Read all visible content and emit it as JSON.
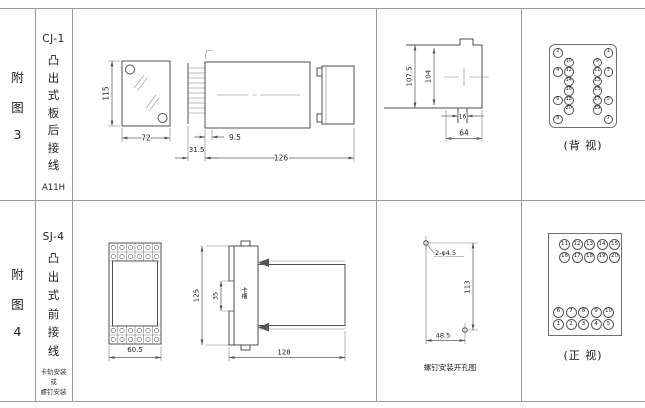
{
  "figures": {
    "fig3": {
      "index_chars": [
        "附",
        "图",
        "3"
      ],
      "model": "CJ-1",
      "type_chars": [
        "凸",
        "出",
        "式",
        "板",
        "后",
        "接",
        "线"
      ],
      "code": "A11H",
      "dims": {
        "front_height": "115",
        "front_width": "72",
        "terminal_depth": "31.5",
        "pin_offset": "9.5",
        "body_length": "126",
        "cutout_height": "107.5",
        "inner_height": "104",
        "stud_width": "16",
        "flange_width": "64"
      },
      "back_view": {
        "caption": "(背 视)",
        "rows": [
          [
            "2",
            "",
            "",
            "1"
          ],
          [
            "",
            "10",
            "9",
            ""
          ],
          [
            "4",
            "12",
            "11",
            "3"
          ],
          [
            "",
            "14",
            "13",
            ""
          ],
          [
            "",
            "16",
            "15",
            ""
          ],
          [
            "6",
            "18",
            "17",
            "5"
          ],
          [
            "",
            "20",
            "19",
            ""
          ],
          [
            "8",
            "",
            "",
            "7"
          ]
        ]
      }
    },
    "fig4": {
      "index_chars": [
        "附",
        "图",
        "4"
      ],
      "model": "SJ-4",
      "type_chars": [
        "凸",
        "出",
        "式",
        "前",
        "接",
        "线"
      ],
      "mount_lines": [
        "卡轨安装",
        "或",
        "螺钉安装"
      ],
      "dims": {
        "front_width": "60.5",
        "body_height": "125",
        "slot_height": "35",
        "slot_label": "卡槽",
        "body_length": "128",
        "hole_note": "2-φ4.5",
        "hole_spacing_v": "113",
        "hole_spacing_h": "48.5"
      },
      "drill_caption": "螺钉安装开孔图",
      "front_view": {
        "caption": "(正 视)",
        "top_rows": [
          [
            "11",
            "12",
            "13",
            "14",
            "15"
          ],
          [
            "16",
            "17",
            "18",
            "19",
            "20"
          ]
        ],
        "bottom_rows": [
          [
            "6",
            "7",
            "8",
            "9",
            "10"
          ],
          [
            "1",
            "2",
            "3",
            "4",
            "5"
          ]
        ]
      }
    }
  }
}
